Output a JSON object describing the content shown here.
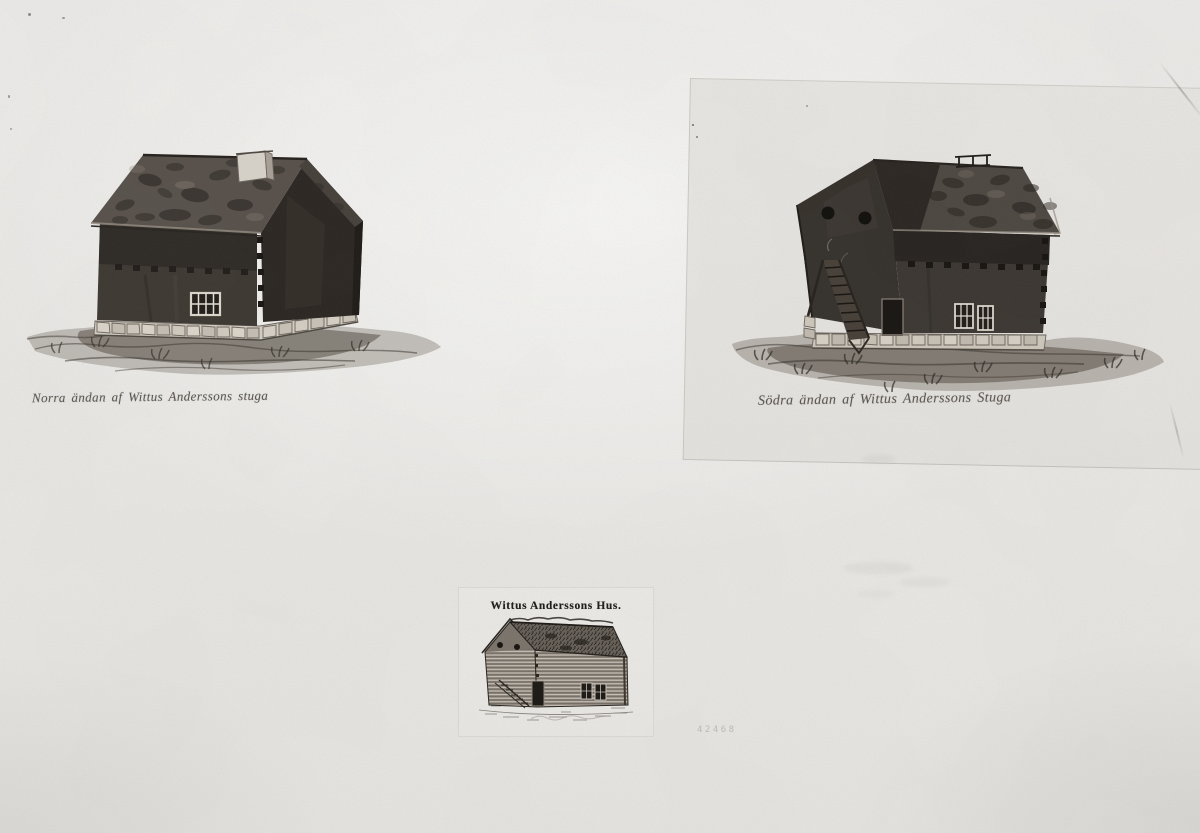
{
  "photo": {
    "media": "black-and-white archival photograph of three house depictions",
    "subject": "Wittus Anderssons stuga (Wittus Andersson's cottage)",
    "palette": {
      "paper": "#e9e7e4",
      "bright_paper": "#efeeeb",
      "ink_dark": "#26221e",
      "ink_mid": "#4c4640",
      "stone_light": "#d8d2c8",
      "caption_ink": "#5b554f"
    }
  },
  "left_drawing": {
    "caption": "Norra ändan af Wittus Anderssons stuga"
  },
  "right_drawing": {
    "caption": "Södra ändan af Wittus Anderssons Stuga"
  },
  "engraving": {
    "title": "Wittus Anderssons Hus."
  },
  "archive_number": "42468"
}
